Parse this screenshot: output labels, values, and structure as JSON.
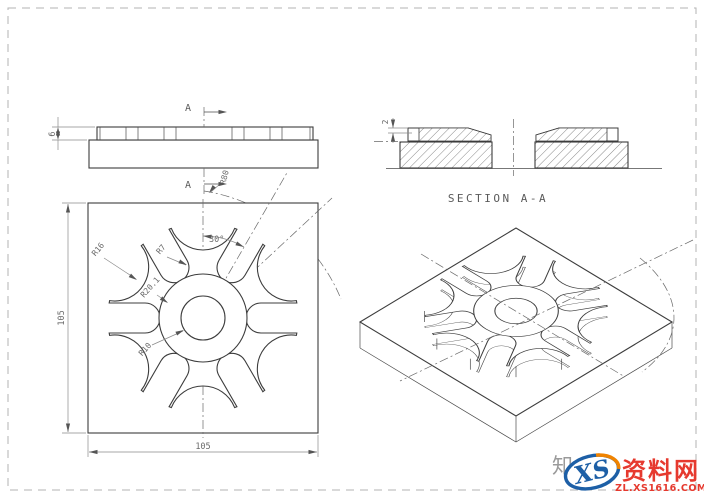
{
  "drawing": {
    "front_view": {
      "cut_label_top": "A",
      "cut_label_bottom": "A",
      "dim_tooth_height": "6",
      "dim_arc_radius": "R80"
    },
    "section_view": {
      "caption": "SECTION A-A",
      "dim_recess_depth": "2"
    },
    "plan_view": {
      "dim_width": "105",
      "dim_height": "105",
      "dim_notch_radius": "R16",
      "dim_slot_end_radius": "R7",
      "dim_boss_radius": "R20.1",
      "dim_hole_radius": "R10",
      "dim_slot_angle": "30°"
    }
  },
  "watermark": {
    "cn_prefix": "知",
    "logo_text": "XS",
    "site_name": "资料网",
    "site_url": "ZL.XS1616.COM",
    "colors": {
      "red": "#e6392e",
      "blue": "#1d5fa6",
      "orange": "#f08300",
      "gray": "#9a9a9a"
    }
  }
}
